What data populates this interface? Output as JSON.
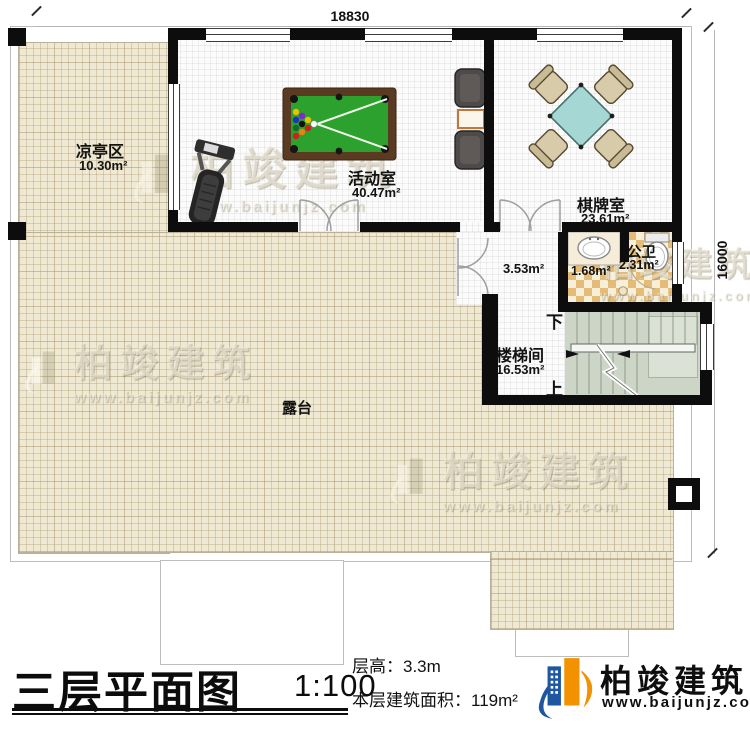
{
  "dims": {
    "top": "18830",
    "right": "16000"
  },
  "rooms": {
    "pavilion": {
      "name": "凉亭区",
      "area": "10.30m²"
    },
    "activity": {
      "name": "活动室",
      "area": "40.47m²"
    },
    "chess": {
      "name": "棋牌室",
      "area": "23.61m²"
    },
    "hall": {
      "area": "3.53m²"
    },
    "basin": {
      "area": "1.68m²"
    },
    "toilet": {
      "name": "公卫",
      "area": "2.31m²"
    },
    "stairwell": {
      "name": "楼梯间",
      "area": "16.53m²",
      "down": "下",
      "up": "上"
    },
    "terrace": {
      "name": "露台"
    }
  },
  "titleblock": {
    "title": "三层平面图",
    "scale": "1:100",
    "floor_height": "层高：3.3m",
    "floor_area": "本层建筑面积：119m²"
  },
  "brand": {
    "name": "柏竣建筑",
    "url": "www.baijunjz.com"
  },
  "watermark": {
    "name": "柏竣建筑",
    "url": "www.baijunjz.com"
  },
  "colors": {
    "wall": "#0d0d0d",
    "terrace": "#efe8d2",
    "stairs": "#ccd5c6",
    "pool_felt": "#2da12e",
    "card_table": "#a5d8d4",
    "tile": "#e5bc77",
    "brand_blue": "#1e56a0",
    "brand_orange": "#f39200"
  }
}
